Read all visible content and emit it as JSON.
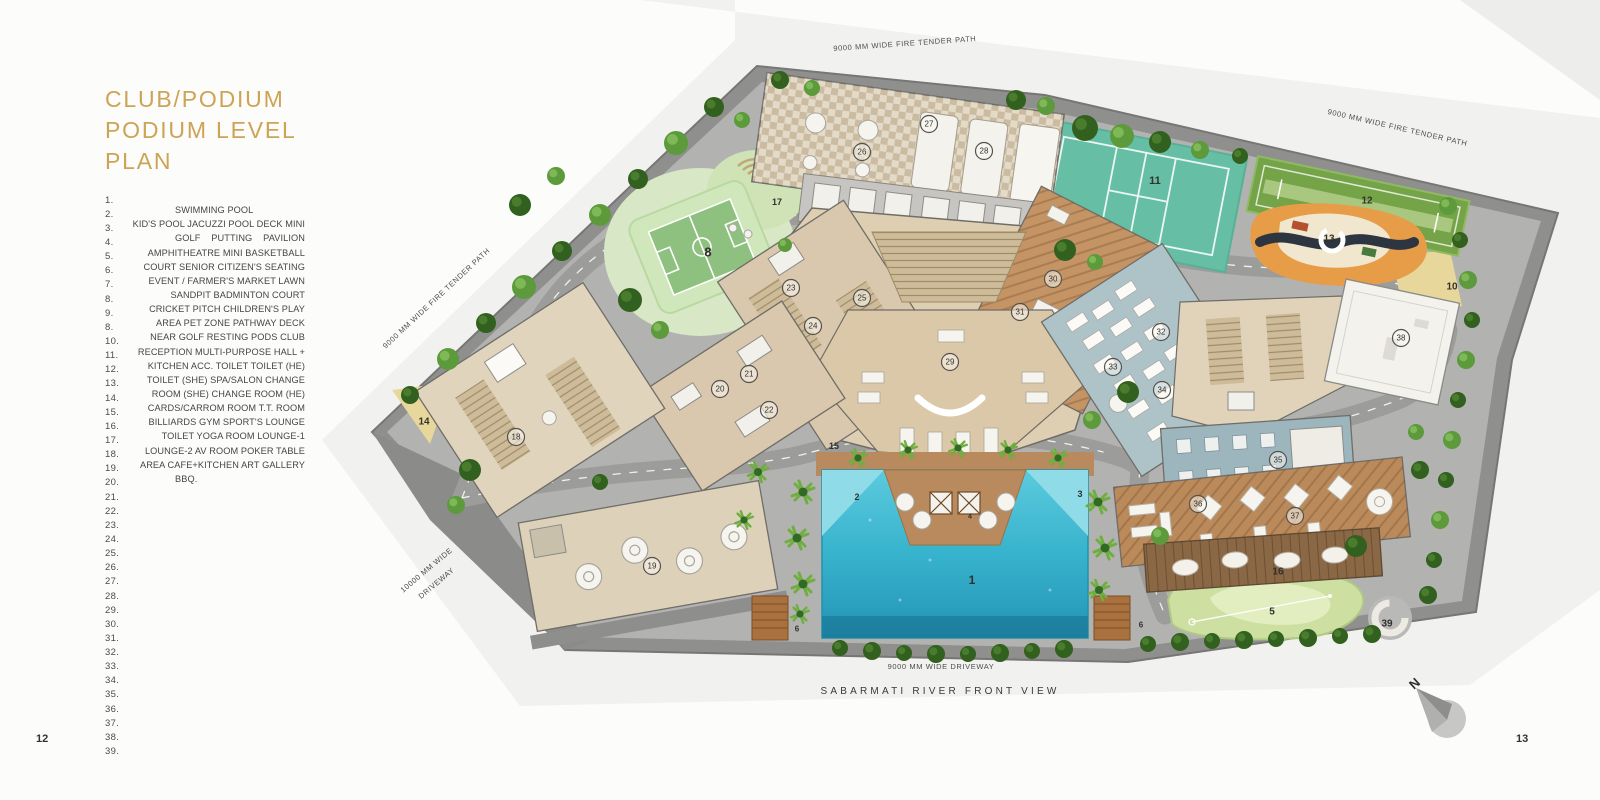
{
  "page": {
    "left_number": "12",
    "right_number": "13"
  },
  "title": {
    "line1": "CLUB/PODIUM",
    "line2": "PODIUM LEVEL PLAN"
  },
  "colors": {
    "accent_gold": "#cda355",
    "pool_blue": "#35b2cc",
    "podium_gray": "#a5a5a3",
    "court_teal": "#66bfa4"
  },
  "legend": {
    "items": [
      {
        "no": "1.",
        "text": ""
      },
      {
        "no": "2.",
        "text": "SWIMMING POOL",
        "stretch": false
      },
      {
        "no": "3.",
        "text": "KID'S POOL JACUZZI POOL DECK MINI"
      },
      {
        "no": "4.",
        "text": "GOLF PUTTING PAVILION"
      },
      {
        "no": "5.",
        "text": "AMPHITHEATRE MINI BASKETBALL"
      },
      {
        "no": "6.",
        "text": "COURT SENIOR CITIZEN'S SEATING"
      },
      {
        "no": "7.",
        "text": "EVENT / FARMER'S MARKET LAWN"
      },
      {
        "no": "8.",
        "text": "SANDPIT BADMINTON COURT"
      },
      {
        "no": "9.",
        "text": "CRICKET PITCH CHILDREN'S PLAY"
      },
      {
        "no": "8.",
        "text": "AREA PET ZONE PATHWAY DECK"
      },
      {
        "no": "10.",
        "text": "NEAR GOLF RESTING PODS CLUB"
      },
      {
        "no": "11.",
        "text": "RECEPTION MULTI-PURPOSE HALL +"
      },
      {
        "no": "12.",
        "text": "KITCHEN ACC. TOILET TOILET (HE)"
      },
      {
        "no": "13.",
        "text": "TOILET (SHE) SPA/SALON CHANGE"
      },
      {
        "no": "14.",
        "text": "ROOM (SHE) CHANGE ROOM (HE)"
      },
      {
        "no": "15.",
        "text": "CARDS/CARROM ROOM T.T. ROOM"
      },
      {
        "no": "16.",
        "text": "BILLIARDS GYM SPORT'S LOUNGE"
      },
      {
        "no": "17.",
        "text": "TOILET YOGA ROOM LOUNGE-1"
      },
      {
        "no": "18.",
        "text": "LOUNGE-2 AV ROOM POKER TABLE"
      },
      {
        "no": "19.",
        "text": "AREA CAFE+KITCHEN ART GALLERY"
      },
      {
        "no": "20.",
        "text": "BBQ.",
        "stretch": false
      },
      {
        "no": "21.",
        "text": ""
      },
      {
        "no": "22.",
        "text": ""
      },
      {
        "no": "23.",
        "text": ""
      },
      {
        "no": "24.",
        "text": ""
      },
      {
        "no": "25.",
        "text": ""
      },
      {
        "no": "26.",
        "text": ""
      },
      {
        "no": "27.",
        "text": ""
      },
      {
        "no": "28.",
        "text": ""
      },
      {
        "no": "29.",
        "text": ""
      },
      {
        "no": "30.",
        "text": ""
      },
      {
        "no": "31.",
        "text": ""
      },
      {
        "no": "32.",
        "text": ""
      },
      {
        "no": "33.",
        "text": ""
      },
      {
        "no": "34.",
        "text": ""
      },
      {
        "no": "35.",
        "text": ""
      },
      {
        "no": "36.",
        "text": ""
      },
      {
        "no": "37.",
        "text": ""
      },
      {
        "no": "38.",
        "text": ""
      },
      {
        "no": "39.",
        "text": ""
      }
    ]
  },
  "plan": {
    "labels": {
      "fire_path_top": "9000 MM WIDE FIRE TENDER PATH",
      "fire_path_right": "9000 MM WIDE FIRE TENDER PATH",
      "fire_path_left": "9000 MM WIDE FIRE TENDER PATH",
      "driveway_left_l1": "10000 MM WIDE",
      "driveway_left_l2": "DRIVEWAY",
      "driveway_bottom": "9000 MM WIDE DRIVEWAY",
      "river": "SABARMATI RIVER FRONT VIEW",
      "north": "N"
    },
    "markers": [
      {
        "n": "1",
        "x": 972,
        "y": 580,
        "t": "p",
        "s": 12
      },
      {
        "n": "2",
        "x": 857,
        "y": 497,
        "t": "p",
        "s": 9
      },
      {
        "n": "3",
        "x": 1080,
        "y": 494,
        "t": "p",
        "s": 9
      },
      {
        "n": "4",
        "x": 970,
        "y": 517,
        "t": "p",
        "s": 7
      },
      {
        "n": "5",
        "x": 1272,
        "y": 612,
        "t": "p",
        "s": 10
      },
      {
        "n": "6",
        "x": 797,
        "y": 629,
        "t": "p",
        "s": 8
      },
      {
        "n": "6",
        "x": 1141,
        "y": 625,
        "t": "p",
        "s": 8
      },
      {
        "n": "8",
        "x": 708,
        "y": 252,
        "t": "p",
        "s": 13
      },
      {
        "n": "10",
        "x": 1452,
        "y": 287,
        "t": "p",
        "s": 10
      },
      {
        "n": "11",
        "x": 1155,
        "y": 181,
        "t": "p",
        "s": 11
      },
      {
        "n": "12",
        "x": 1367,
        "y": 201,
        "t": "p",
        "s": 10
      },
      {
        "n": "13",
        "x": 1329,
        "y": 239,
        "t": "p",
        "s": 10
      },
      {
        "n": "14",
        "x": 424,
        "y": 422,
        "t": "p",
        "s": 10
      },
      {
        "n": "15",
        "x": 834,
        "y": 446,
        "t": "p",
        "s": 9
      },
      {
        "n": "16",
        "x": 1278,
        "y": 572,
        "t": "p",
        "s": 10
      },
      {
        "n": "17",
        "x": 777,
        "y": 202,
        "t": "p",
        "s": 9
      },
      {
        "n": "18",
        "x": 516,
        "y": 437,
        "t": "c"
      },
      {
        "n": "19",
        "x": 652,
        "y": 566,
        "t": "c"
      },
      {
        "n": "20",
        "x": 720,
        "y": 389,
        "t": "c"
      },
      {
        "n": "21",
        "x": 749,
        "y": 374,
        "t": "c"
      },
      {
        "n": "22",
        "x": 769,
        "y": 410,
        "t": "c"
      },
      {
        "n": "23",
        "x": 791,
        "y": 288,
        "t": "c"
      },
      {
        "n": "24",
        "x": 813,
        "y": 326,
        "t": "c"
      },
      {
        "n": "25",
        "x": 862,
        "y": 298,
        "t": "c"
      },
      {
        "n": "26",
        "x": 862,
        "y": 152,
        "t": "c"
      },
      {
        "n": "27",
        "x": 929,
        "y": 124,
        "t": "c"
      },
      {
        "n": "28",
        "x": 984,
        "y": 151,
        "t": "c"
      },
      {
        "n": "29",
        "x": 950,
        "y": 362,
        "t": "c"
      },
      {
        "n": "30",
        "x": 1053,
        "y": 279,
        "t": "c"
      },
      {
        "n": "31",
        "x": 1020,
        "y": 312,
        "t": "c"
      },
      {
        "n": "32",
        "x": 1161,
        "y": 332,
        "t": "c"
      },
      {
        "n": "33",
        "x": 1113,
        "y": 367,
        "t": "c"
      },
      {
        "n": "34",
        "x": 1162,
        "y": 390,
        "t": "c"
      },
      {
        "n": "35",
        "x": 1278,
        "y": 460,
        "t": "c"
      },
      {
        "n": "36",
        "x": 1198,
        "y": 504,
        "t": "c"
      },
      {
        "n": "37",
        "x": 1295,
        "y": 516,
        "t": "c"
      },
      {
        "n": "38",
        "x": 1401,
        "y": 338,
        "t": "c"
      },
      {
        "n": "39",
        "x": 1387,
        "y": 624,
        "t": "p",
        "s": 10
      }
    ]
  }
}
